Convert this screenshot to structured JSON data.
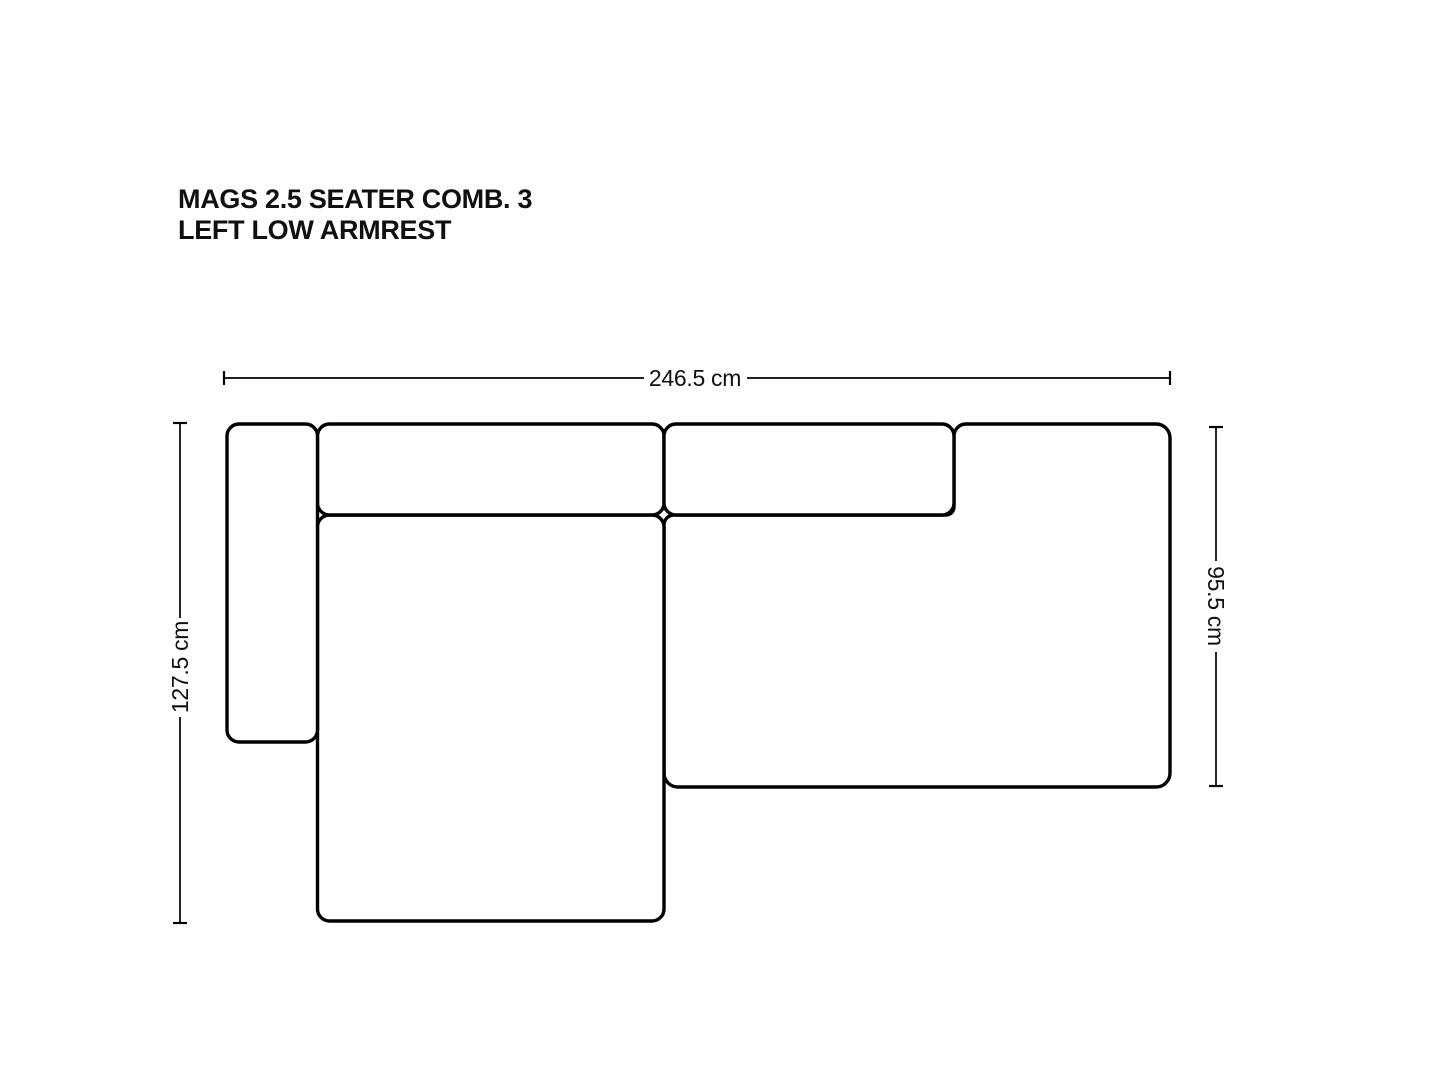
{
  "page": {
    "background": "#ffffff",
    "outline_color": "#000000",
    "text_color": "#101010"
  },
  "header": {
    "title_line1": "MAGS 2.5 SEATER COMB. 3",
    "title_line2": "LEFT LOW ARMREST"
  },
  "dimensions": {
    "overall_width": "246.5 cm",
    "overall_depth_left": "127.5 cm",
    "right_section_depth": "95.5 cm"
  },
  "diagram": {
    "type": "sofa-top-view-line-drawing",
    "modules": [
      "left-low-armrest",
      "back-cushion-left",
      "back-cushion-right",
      "chaise-longue-seat",
      "right-seat-section"
    ]
  }
}
